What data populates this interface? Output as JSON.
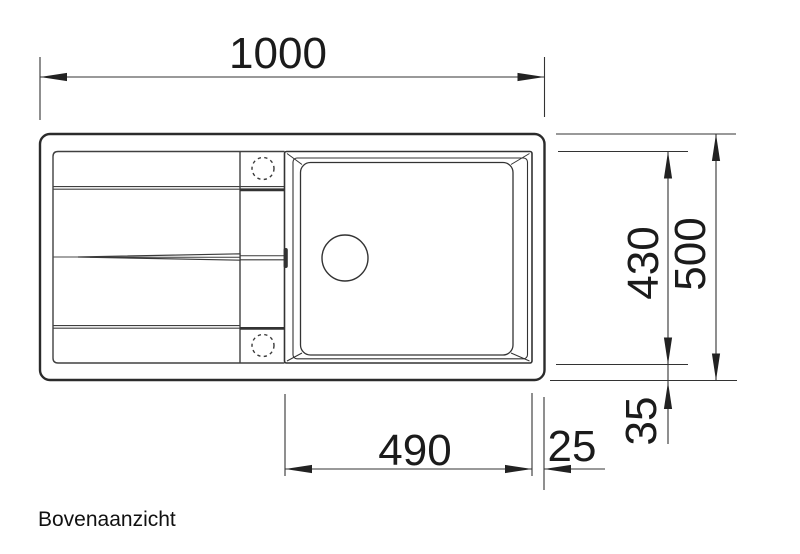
{
  "drawing": {
    "view_label": "Bovenaanzicht",
    "ink_color": "#2d2d2d",
    "background_color": "#ffffff",
    "dimensions": {
      "overall_width": "1000",
      "overall_depth": "500",
      "inner_depth": "430",
      "bowl_width": "490",
      "right_rim": "25",
      "bottom_rim": "35"
    }
  }
}
